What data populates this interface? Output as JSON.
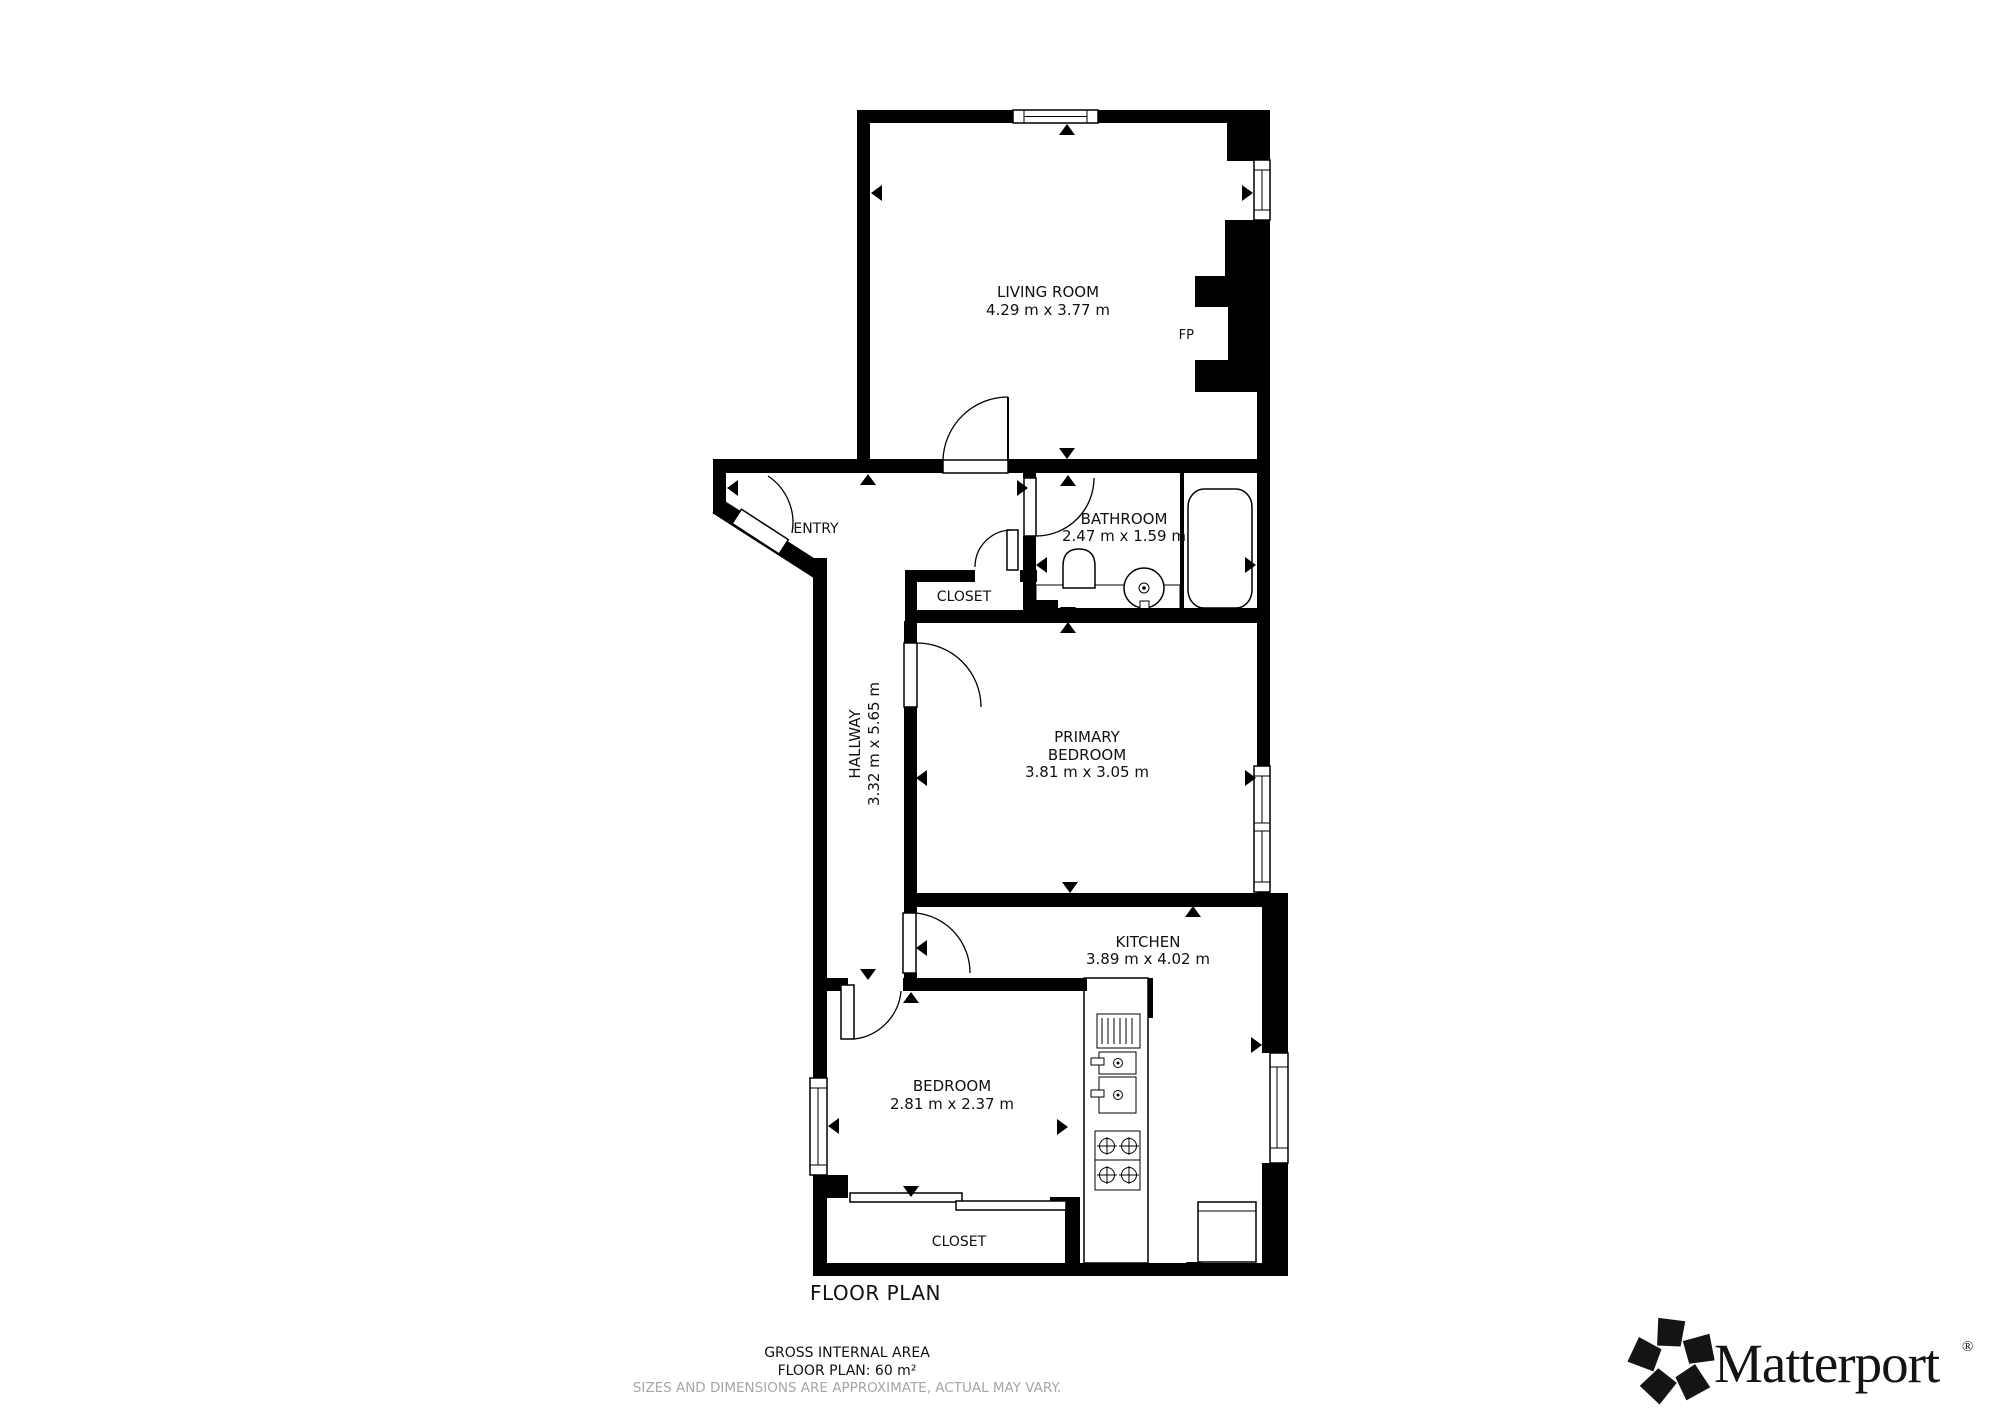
{
  "plan": {
    "title": "FLOOR PLAN",
    "fireplace_label": "FP",
    "rooms": [
      {
        "id": "living-room",
        "name": "LIVING ROOM",
        "dims": "4.29 m x 3.77 m"
      },
      {
        "id": "entry",
        "name": "ENTRY"
      },
      {
        "id": "bathroom",
        "name": "BATHROOM",
        "dims": "2.47 m x 1.59 m"
      },
      {
        "id": "closet-upper",
        "name": "CLOSET"
      },
      {
        "id": "hallway",
        "name": "HALLWAY",
        "dims": "3.32 m x 5.65 m"
      },
      {
        "id": "primary-bedroom",
        "name": "PRIMARY",
        "name_line2": "BEDROOM",
        "dims": "3.81 m x 3.05 m"
      },
      {
        "id": "kitchen",
        "name": "KITCHEN",
        "dims": "3.89 m x 4.02 m"
      },
      {
        "id": "bedroom",
        "name": "BEDROOM",
        "dims": "2.81 m x 2.37 m"
      },
      {
        "id": "closet-lower",
        "name": "CLOSET"
      }
    ]
  },
  "footer": {
    "gross_internal_area": "GROSS INTERNAL AREA",
    "floor_plan_area": "FLOOR PLAN: 60 m²",
    "disclaimer": "SIZES AND DIMENSIONS ARE APPROXIMATE, ACTUAL MAY VARY."
  },
  "branding": {
    "logo_text": "Matterport",
    "registered_mark": "®"
  },
  "colors": {
    "wall": "#000000",
    "background": "#ffffff",
    "muted_text": "#a6a6a6"
  }
}
